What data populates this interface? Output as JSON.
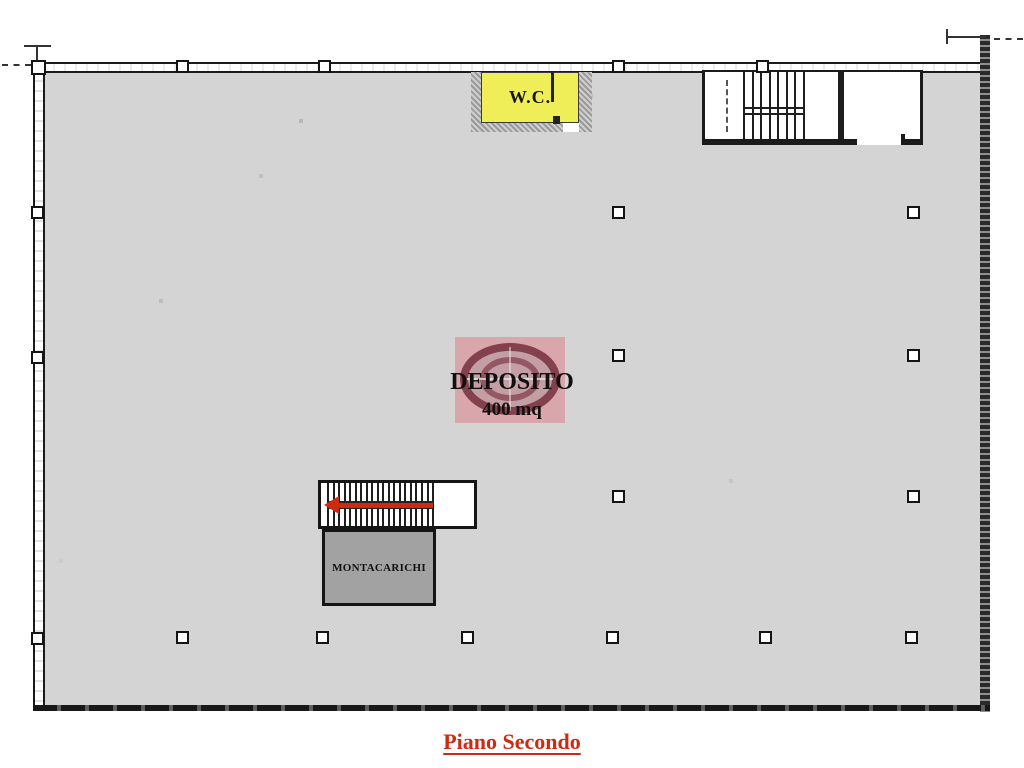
{
  "plan": {
    "floor_title": "Piano Secondo",
    "rooms": {
      "deposito": {
        "label": "DEPOSITO",
        "area": "400 mq"
      },
      "wc": {
        "label": "W.C."
      },
      "montacarichi": {
        "label": "MONTACARICHI"
      }
    },
    "colors": {
      "floor_fill": "#d4d4d4",
      "wc_fill": "#f0ee58",
      "montacarichi_fill": "#a2a2a2",
      "accent_red": "#cc2b12",
      "watermark_pink": "#daa3aa",
      "watermark_ring": "#7c3642",
      "line": "#1b1b1b"
    },
    "columns": [
      {
        "x": 618,
        "y": 212
      },
      {
        "x": 913,
        "y": 212
      },
      {
        "x": 618,
        "y": 355
      },
      {
        "x": 913,
        "y": 355
      },
      {
        "x": 618,
        "y": 496
      },
      {
        "x": 913,
        "y": 496
      },
      {
        "x": 182,
        "y": 637
      },
      {
        "x": 322,
        "y": 637
      },
      {
        "x": 467,
        "y": 637
      },
      {
        "x": 612,
        "y": 637
      },
      {
        "x": 765,
        "y": 637
      },
      {
        "x": 911,
        "y": 637
      }
    ],
    "wall_pillars": {
      "top_x": [
        182,
        324,
        618,
        762
      ],
      "left_y": [
        212,
        357,
        638
      ]
    },
    "stairs": {
      "top_right_treads": 8,
      "mid_treads": 20
    }
  }
}
